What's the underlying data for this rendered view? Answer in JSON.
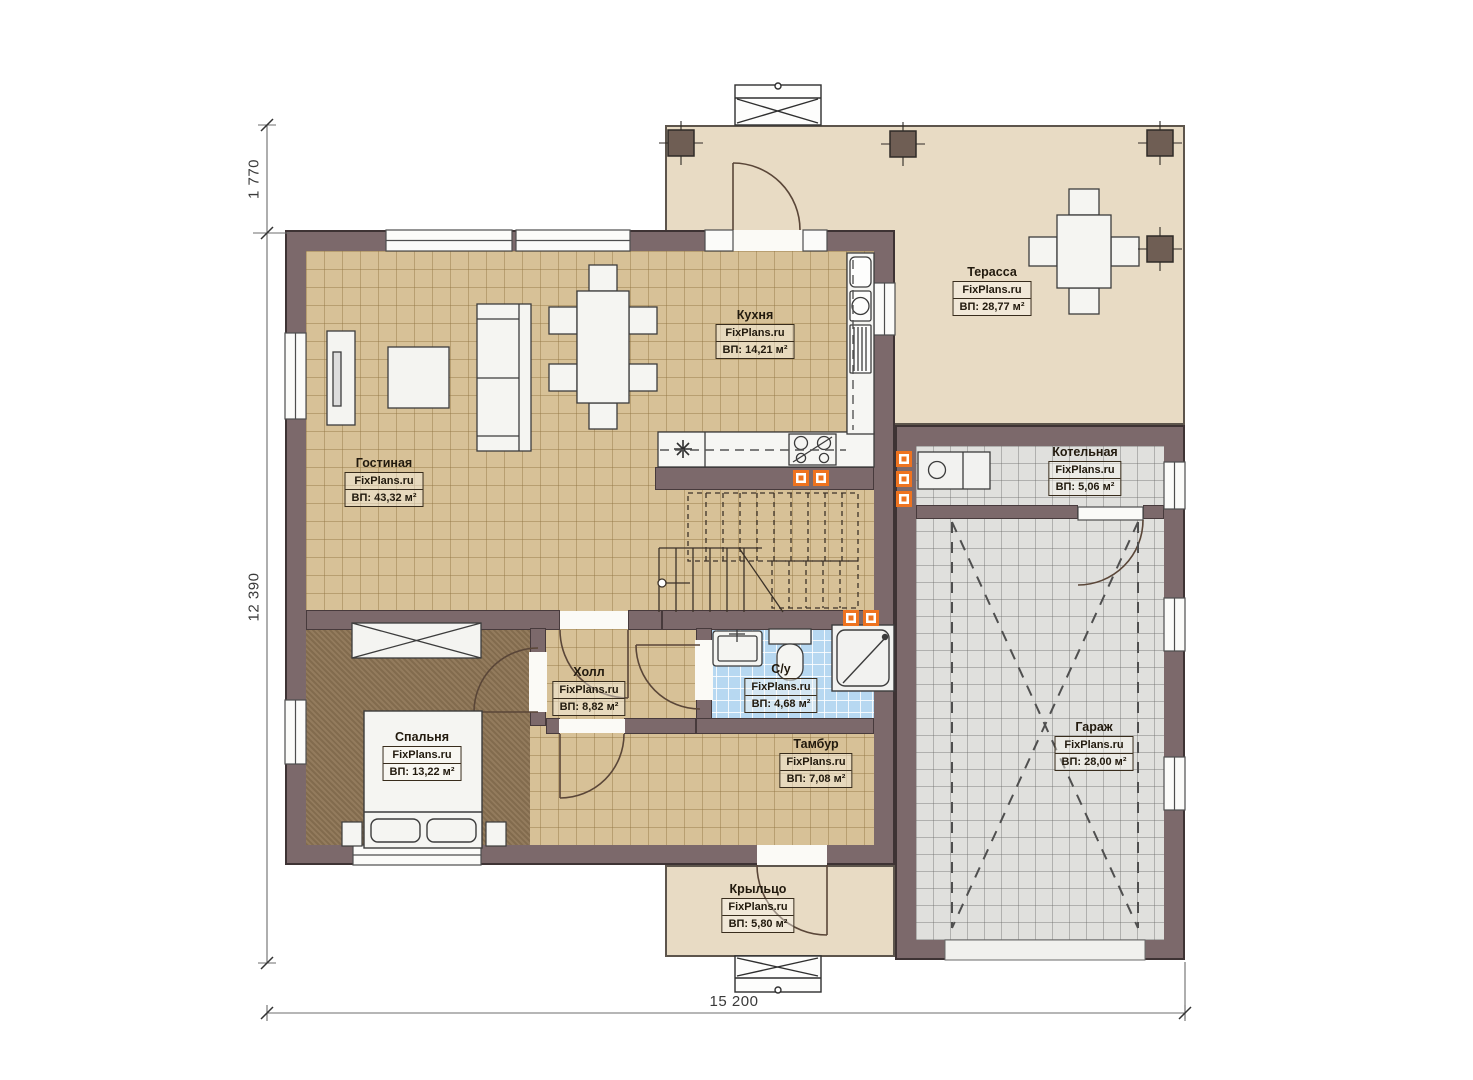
{
  "plan": {
    "brand": "FixPlans.ru",
    "rooms": [
      {
        "id": "living",
        "name": "Гостиная",
        "area": "ВП: 43,32 м²"
      },
      {
        "id": "kitchen",
        "name": "Кухня",
        "area": "ВП: 14,21 м²"
      },
      {
        "id": "terrace",
        "name": "Терасса",
        "area": "ВП: 28,77 м²"
      },
      {
        "id": "boiler",
        "name": "Котельная",
        "area": "ВП: 5,06 м²"
      },
      {
        "id": "hall",
        "name": "Холл",
        "area": "ВП: 8,82 м²"
      },
      {
        "id": "bathroom",
        "name": "С/у",
        "area": "ВП: 4,68 м²"
      },
      {
        "id": "bedroom",
        "name": "Спальня",
        "area": "ВП: 13,22 м²"
      },
      {
        "id": "vestibule",
        "name": "Тамбур",
        "area": "ВП: 7,08 м²"
      },
      {
        "id": "garage",
        "name": "Гараж",
        "area": "ВП: 28,00 м²"
      },
      {
        "id": "porch",
        "name": "Крыльцо",
        "area": "ВП: 5,80 м²"
      }
    ],
    "dimensions": {
      "terrace_depth": "1 770",
      "house_height": "12 390",
      "house_width": "15 200"
    },
    "colors": {
      "wall": "#7c696b",
      "wood_floor": "#d7c197",
      "terrace_floor": "#e8dbc4",
      "garage_floor": "#e0e0dd",
      "bathroom_floor": "#b7d8f1",
      "bedroom_floor": "#8d7454",
      "socket_accent": "#ee7320"
    }
  }
}
